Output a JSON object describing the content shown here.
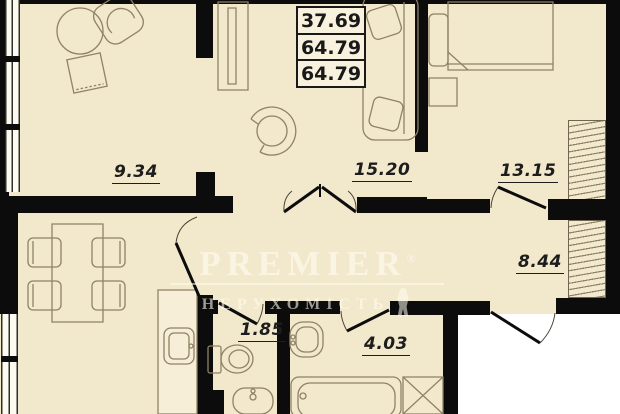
{
  "watermark": {
    "brand": "PREMIER",
    "registered": "®",
    "subtitle": "НЕРУХОМІСТЬ"
  },
  "area_summary": {
    "values": [
      "37.69",
      "64.79",
      "64.79"
    ]
  },
  "room_labels": {
    "top_left": "9.34",
    "living": "15.20",
    "bedroom": "13.15",
    "hallway": "8.44",
    "wc": "1.85",
    "bathroom": "4.03"
  },
  "colors": {
    "floor": "#f2e8cb",
    "walls": "#0c0c0c",
    "furniture_outline": "#8f8265",
    "outside": "#ffffff",
    "area_box_bg": "#f8f1dd",
    "label_text": "#1d1d1d",
    "watermark_text": "#fffcf0"
  }
}
